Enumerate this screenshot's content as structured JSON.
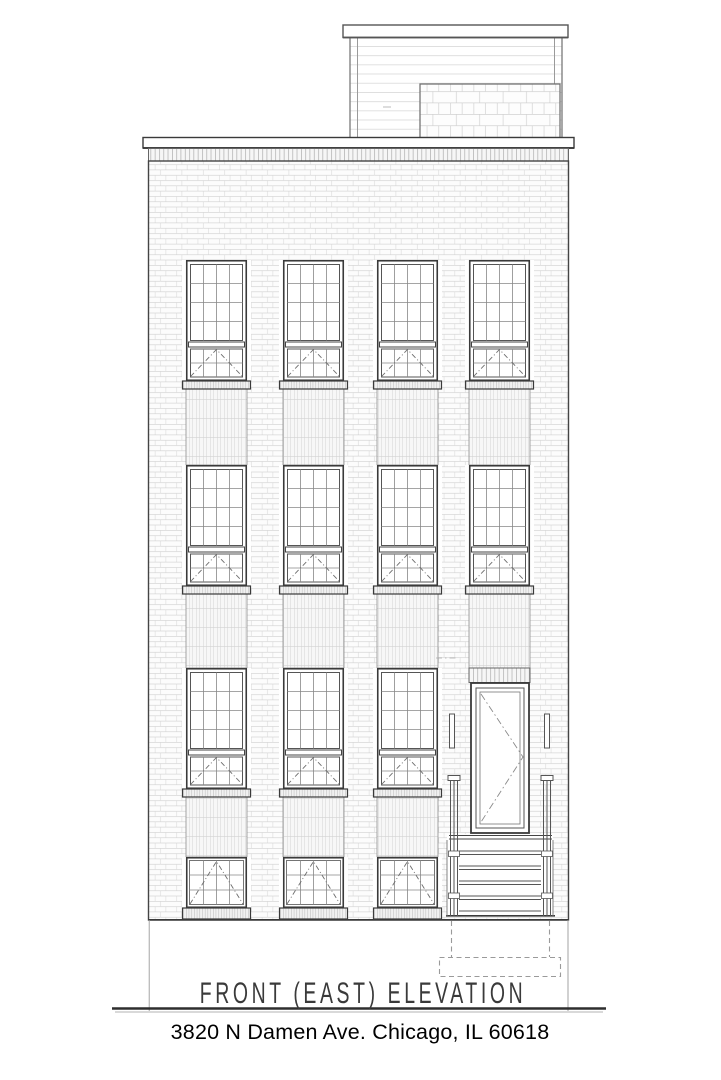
{
  "drawing": {
    "title": "FRONT (EAST)  ELEVATION",
    "address": "3820 N Damen Ave. Chicago, IL 60618",
    "building": {
      "stories": 4,
      "window_columns": 4,
      "upper_window_grid": "4x4 fixed over 4x2 awning sash",
      "ground_window_grid": "4x3 awning",
      "features": [
        "rooftop penthouse with horizontal siding and masonry block wall",
        "parapet coping with soldier-course band",
        "running-bond brick facade",
        "stacked-brick spandrel panels below windows",
        "entry door with swing symbol, sconces and stoop stair",
        "dashed below-grade stair footprint"
      ]
    },
    "colors": {
      "paper": "#ffffff",
      "line_dark": "#3a3a3a",
      "line_medium": "#777777",
      "line_light": "#cccccc",
      "dash_line": "#999999"
    }
  }
}
